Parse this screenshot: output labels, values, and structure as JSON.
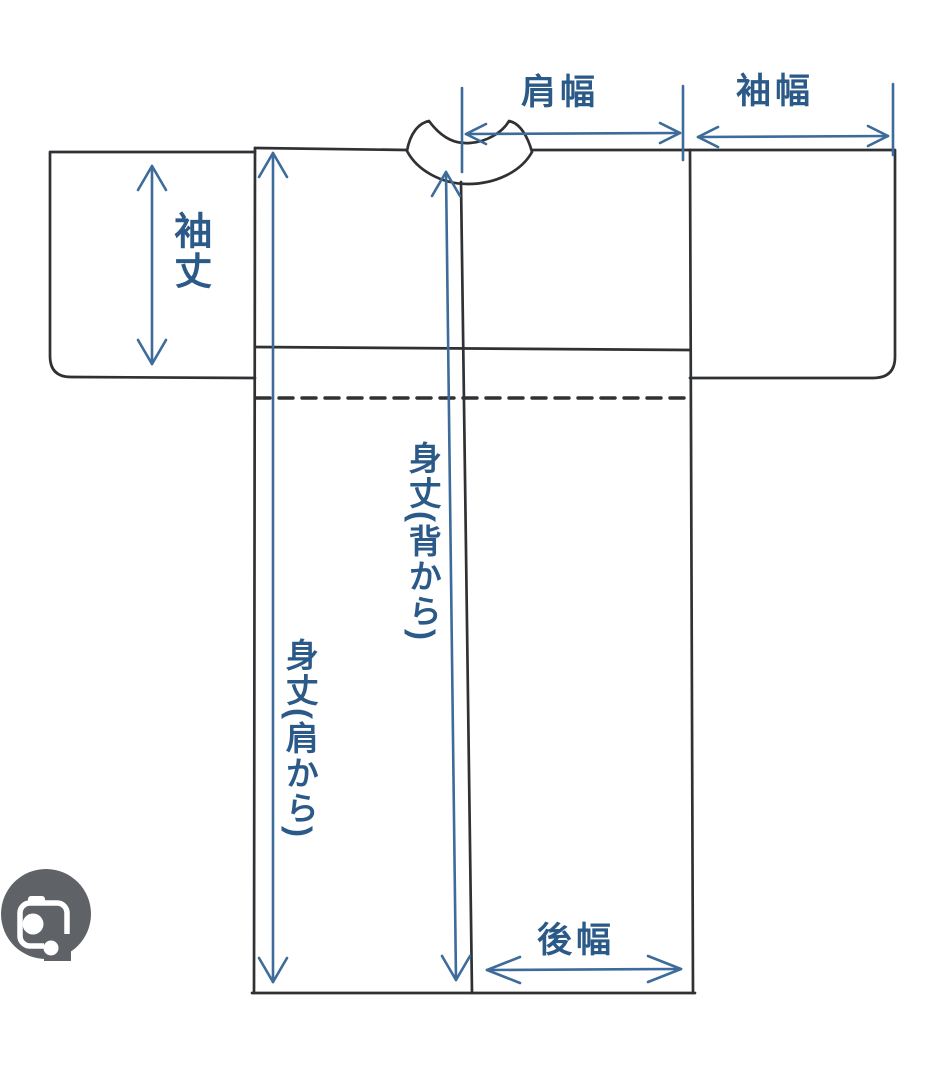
{
  "diagram": {
    "title": "kimono-measurement-diagram",
    "labels": {
      "shoulder_width": "肩幅",
      "sleeve_width": "袖幅",
      "sleeve_length": "袖丈",
      "body_length_back": "身丈(背から)",
      "body_length_shoulder": "身丈(肩から)",
      "back_width": "後幅"
    },
    "colors": {
      "background": "#ffffff",
      "outline": "#2f3134",
      "annotation": "#3d6b9a",
      "label_text": "#2b5a88",
      "camera_icon_bg": "#5f6368",
      "camera_icon_glyph": "#ffffff"
    },
    "icons": {
      "camera_button": "lens-camera-icon"
    }
  }
}
